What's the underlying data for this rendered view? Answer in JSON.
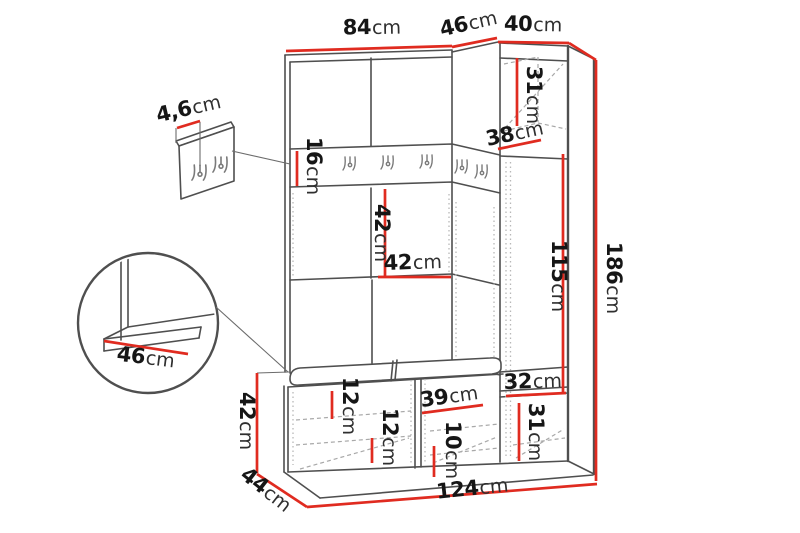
{
  "diagram": {
    "type": "furniture-dimension-drawing",
    "subject": "hallway wardrobe unit with hook rail, bench and tall cabinet",
    "accent_color": "#e02b20",
    "outline_color": "#4f4f4f",
    "unit_system": "cm",
    "measurements": {
      "top_width": {
        "value": "84",
        "unit": "cm"
      },
      "top_depth": {
        "value": "46",
        "unit": "cm"
      },
      "right_cabinet_width": {
        "value": "40",
        "unit": "cm"
      },
      "right_cabinet_top_section_height": {
        "value": "31",
        "unit": "cm"
      },
      "right_cabinet_shelf_depth": {
        "value": "38",
        "unit": "cm"
      },
      "hook_rail_height": {
        "value": "16",
        "unit": "cm"
      },
      "niche_height": {
        "value": "42",
        "unit": "cm"
      },
      "niche_width": {
        "value": "42",
        "unit": "cm"
      },
      "right_door_height": {
        "value": "115",
        "unit": "cm"
      },
      "total_height": {
        "value": "186",
        "unit": "cm"
      },
      "right_cabinet_mid_section_height": {
        "value": "32",
        "unit": "cm"
      },
      "right_cabinet_bottom_section_height": {
        "value": "31",
        "unit": "cm"
      },
      "hook_panel_thickness": {
        "value": "4,6",
        "unit": "cm"
      },
      "seat_detail_depth": {
        "value": "46",
        "unit": "cm"
      },
      "bench_height": {
        "value": "42",
        "unit": "cm"
      },
      "bench_depth": {
        "value": "44",
        "unit": "cm"
      },
      "total_width": {
        "value": "124",
        "unit": "cm"
      },
      "bench_left_top_clearance": {
        "value": "12",
        "unit": "cm"
      },
      "bench_left_shelf_clearance": {
        "value": "12",
        "unit": "cm"
      },
      "bench_right_compartment_width": {
        "value": "39",
        "unit": "cm"
      },
      "bench_right_shelf_clearance": {
        "value": "10",
        "unit": "cm"
      }
    }
  }
}
